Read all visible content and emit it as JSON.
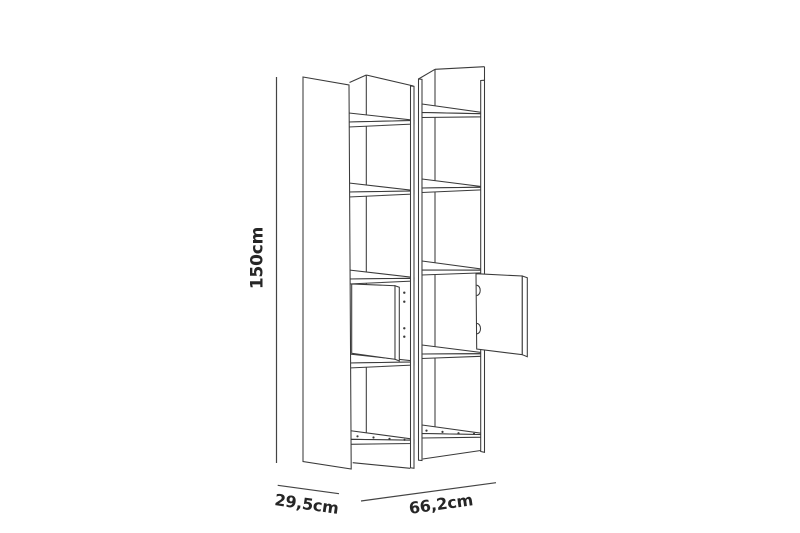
{
  "diagram": {
    "type": "furniture-dimension-line-drawing",
    "subject": "tall bookcase with two shelf columns, one open door per column",
    "background_color": "#ffffff",
    "line_color": "#3a3a3a",
    "text_color": "#262626",
    "dimensions": {
      "height_label": "150cm",
      "depth_label": "29,5cm",
      "width_label": "66,2cm"
    }
  }
}
